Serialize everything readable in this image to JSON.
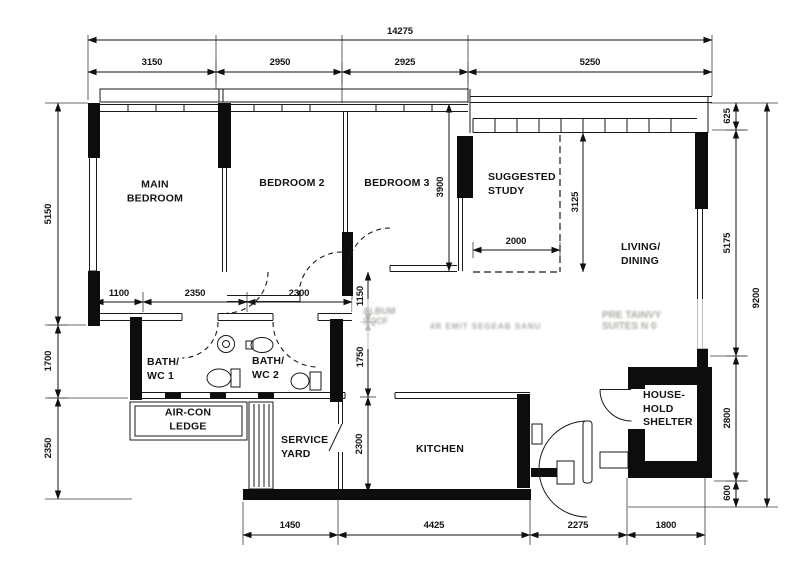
{
  "colors": {
    "line": "#111111",
    "wall": "#0d0d0d",
    "background": "#ffffff"
  },
  "dims": {
    "top_total": "14275",
    "top": [
      "3150",
      "2950",
      "2925",
      "5250"
    ],
    "left": [
      "5150",
      "1700",
      "2350"
    ],
    "right": [
      "625",
      "5175",
      "2800",
      "600"
    ],
    "right_total": "9200",
    "bottom": [
      "1450",
      "4425",
      "2275",
      "1800"
    ],
    "hall": [
      "1100",
      "2350",
      "2300"
    ],
    "study_width": "2000",
    "bedroom3_depth": "3900",
    "study_depth": "3125",
    "hall_v": [
      "1150",
      "1750"
    ],
    "kitchen_depth": "2300"
  },
  "rooms": {
    "main_bedroom": "MAIN\nBEDROOM",
    "bedroom2": "BEDROOM 2",
    "bedroom3": "BEDROOM 3",
    "study": "SUGGESTED\nSTUDY",
    "living": "LIVING/\nDINING",
    "bath1": "BATH/\nWC 1",
    "bath2": "BATH/\nWC 2",
    "aircon": "AIR-CON\nLEDGE",
    "service": "SERVICE\nYARD",
    "kitchen": "KITCHEN",
    "shelter": "HOUSE-\nHOLD\nSHELTER"
  },
  "watermark": {
    "left": "ALBUM\nSQCF",
    "mid": "4R EMIT SEGEAB SANU",
    "right": "PRE TAINVY\nSUITES N 0"
  }
}
